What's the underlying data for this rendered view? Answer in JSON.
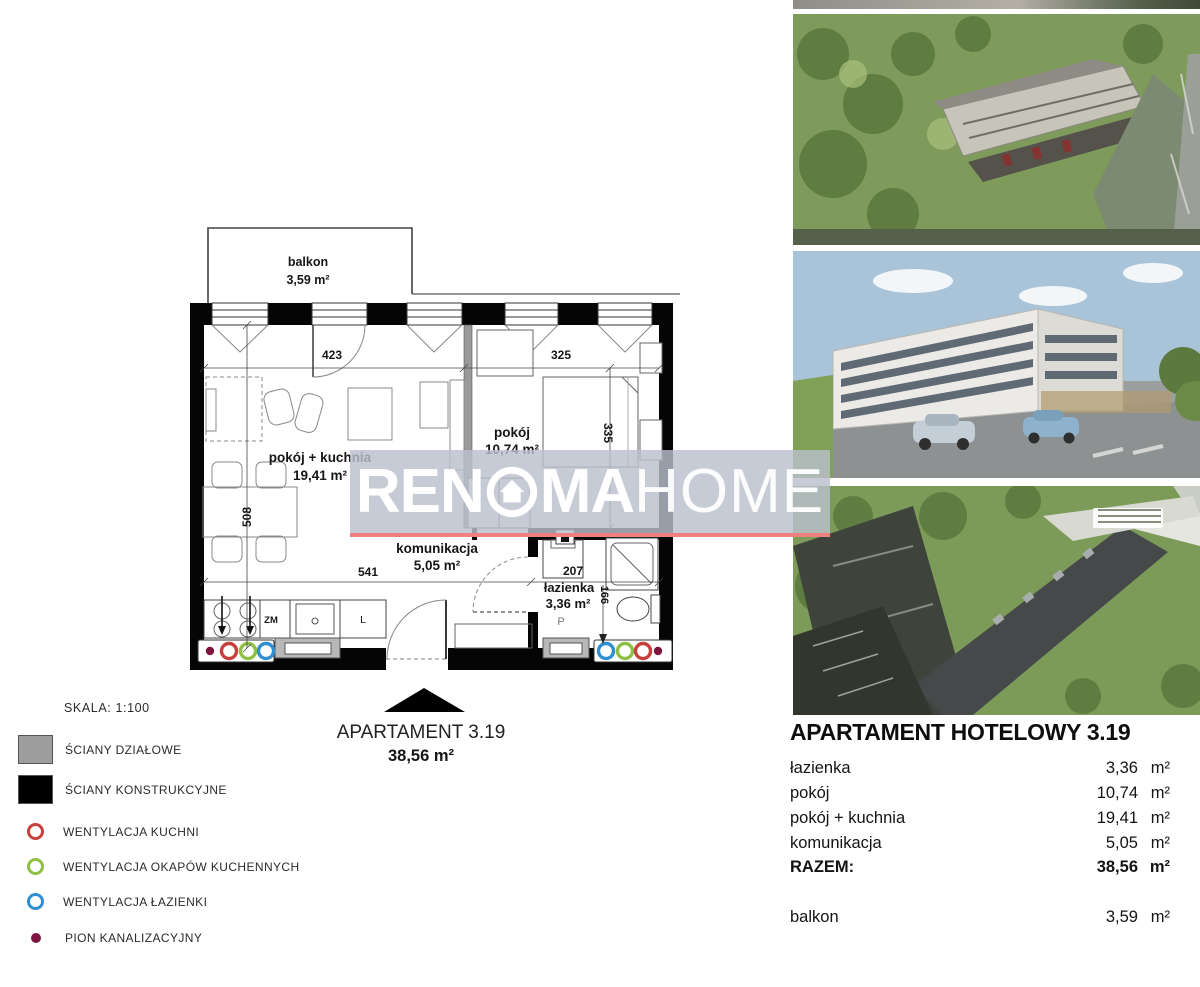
{
  "plan": {
    "balcony": {
      "label": "balkon",
      "area": "3,59 m²"
    },
    "rooms": {
      "living": {
        "name": "pokój + kuchnia",
        "area": "19,41 m²"
      },
      "bedroom": {
        "name": "pokój",
        "area": "10,74 m²"
      },
      "hall": {
        "name": "komunikacja",
        "area": "5,05 m²"
      },
      "bath": {
        "name": "łazienka",
        "area": "3,36 m²"
      }
    },
    "dims": {
      "w_living": "423",
      "w_bedroom": "325",
      "h_living": "508",
      "w_hall": "541",
      "w_bath": "207",
      "h_bath": "166",
      "h_bedroom": "335"
    },
    "appliances": {
      "dishwasher": "ZM",
      "fridge": "L",
      "washer": "P"
    },
    "footer": {
      "title": "APARTAMENT 3.19",
      "area": "38,56 m²"
    }
  },
  "legend": {
    "scale": "SKALA: 1:100",
    "items": [
      {
        "icon": "partition-wall-swatch",
        "color": "#9e9e9e",
        "label": "ŚCIANY DZIAŁOWE"
      },
      {
        "icon": "structural-wall-swatch",
        "color": "#000000",
        "label": "ŚCIANY KONSTRUKCYJNE"
      },
      {
        "icon": "kitchen-vent-ring",
        "color": "#c8403c",
        "label": "WENTYLACJA KUCHNI"
      },
      {
        "icon": "hood-vent-ring",
        "color": "#8fc045",
        "label": "WENTYLACJA OKAPÓW KUCHENNYCH"
      },
      {
        "icon": "bath-vent-ring",
        "color": "#2f8fd0",
        "label": "WENTYLACJA ŁAZIENKI"
      },
      {
        "icon": "sewage-stack-dot",
        "color": "#7d1540",
        "label": "PION KANALIZACYJNY"
      }
    ]
  },
  "watermark": {
    "brand_prefix": "REN",
    "brand_mid": "MA",
    "brand_suffix": "HOME",
    "house_icon": "house-in-circle",
    "band_color": "rgba(186,192,205,0.82)",
    "underline_color": "#ee8080"
  },
  "vents": {
    "kitchen": "#c8403c",
    "hood": "#8fc045",
    "bath": "#2f8fd0",
    "sewage": "#7d1540"
  },
  "photos": {
    "photo1_desc": "aerial render of triangular building with parking",
    "photo2_desc": "street render of white hotel building with cars",
    "photo3_desc": "aerial render of long building along road"
  },
  "summary": {
    "title": "APARTAMENT HOTELOWY 3.19",
    "rows": [
      {
        "label": "łazienka",
        "value": "3,36",
        "unit": "m²"
      },
      {
        "label": "pokój",
        "value": "10,74",
        "unit": "m²"
      },
      {
        "label": "pokój + kuchnia",
        "value": "19,41",
        "unit": "m²"
      },
      {
        "label": "komunikacja",
        "value": "5,05",
        "unit": "m²"
      }
    ],
    "total": {
      "label": "RAZEM:",
      "value": "38,56",
      "unit": "m²"
    },
    "balcony": {
      "label": "balkon",
      "value": "3,59",
      "unit": "m²"
    }
  }
}
